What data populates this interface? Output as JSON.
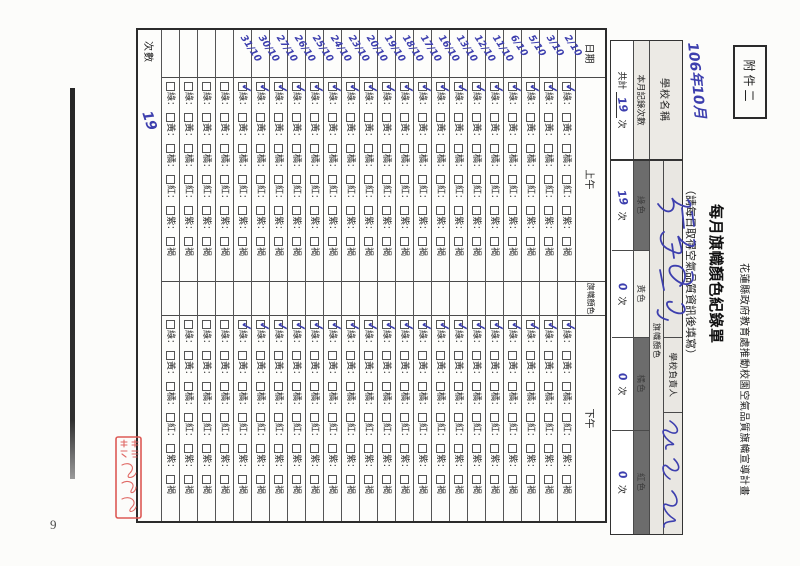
{
  "page": {
    "attachment_label": "附件二",
    "page_number": "9"
  },
  "colors": {
    "handwriting_ink": "#3d3fae",
    "stamp_red": "#dd5a55",
    "table_line": "#4a4a4a"
  },
  "header": {
    "program_line": "花蓮縣政府教育處推動校園空氣品質旗幟宣導計畫",
    "title": "每月旗幟顏色紀錄單",
    "subtitle": "（請每日取得空氣品質資訊後填寫）",
    "handwritten_year_month": "106年10月"
  },
  "school_info": {
    "school_name_label": "學校名稱",
    "month_record_label": "本月記錄次數",
    "total_prefix": "共計",
    "total_value": "19",
    "total_suffix": "次"
  },
  "summary": {
    "officer_label": "學校負責人",
    "flag_color_label": "旗幟顏色",
    "unit": "次",
    "colors": [
      {
        "name": "綠色",
        "count": "19",
        "shade": "dark"
      },
      {
        "name": "黃色",
        "count": "0",
        "shade": "light"
      },
      {
        "name": "橘色",
        "count": "0",
        "shade": "dark"
      },
      {
        "name": "紅色",
        "count": "0",
        "shade": "dark"
      }
    ]
  },
  "table": {
    "headers": {
      "date": "日期",
      "morning": "上午",
      "flag_color": "旗幟顏色",
      "afternoon": "下午",
      "count": "次數"
    },
    "checkbox_options": [
      "綠",
      "黃",
      "橘",
      "紅",
      "紫",
      "褐"
    ],
    "checkbox_option_names": [
      "green",
      "yellow",
      "orange",
      "red",
      "purple",
      "brown"
    ],
    "option_separator": "：",
    "check_glyph": "✓",
    "count_total": "19",
    "rows": [
      {
        "date": "2/10",
        "am": "綠",
        "pm": "綠"
      },
      {
        "date": "3/10",
        "am": "綠",
        "pm": "綠"
      },
      {
        "date": "5/10",
        "am": "綠",
        "pm": "綠"
      },
      {
        "date": "6/10",
        "am": "綠",
        "pm": "綠"
      },
      {
        "date": "11/10",
        "am": "綠",
        "pm": "綠"
      },
      {
        "date": "12/10",
        "am": "綠",
        "pm": "綠"
      },
      {
        "date": "13/10",
        "am": "綠",
        "pm": "綠"
      },
      {
        "date": "16/10",
        "am": "綠",
        "pm": "綠"
      },
      {
        "date": "17/10",
        "am": "綠",
        "pm": "綠"
      },
      {
        "date": "18/10",
        "am": "綠",
        "pm": "綠"
      },
      {
        "date": "19/10",
        "am": "綠",
        "pm": "綠"
      },
      {
        "date": "20/10",
        "am": "綠",
        "pm": "綠"
      },
      {
        "date": "23/10",
        "am": "綠",
        "pm": "綠"
      },
      {
        "date": "24/10",
        "am": "綠",
        "pm": "綠"
      },
      {
        "date": "25/10",
        "am": "綠",
        "pm": "綠"
      },
      {
        "date": "26/10",
        "am": "綠",
        "pm": "綠"
      },
      {
        "date": "27/10",
        "am": "綠",
        "pm": "綠"
      },
      {
        "date": "30/10",
        "am": "綠",
        "pm": "綠"
      },
      {
        "date": "31/10",
        "am": "綠",
        "pm": "綠"
      },
      {
        "date": "",
        "am": "",
        "pm": ""
      },
      {
        "date": "",
        "am": "",
        "pm": ""
      },
      {
        "date": "",
        "am": "",
        "pm": ""
      },
      {
        "date": "",
        "am": "",
        "pm": ""
      }
    ]
  }
}
